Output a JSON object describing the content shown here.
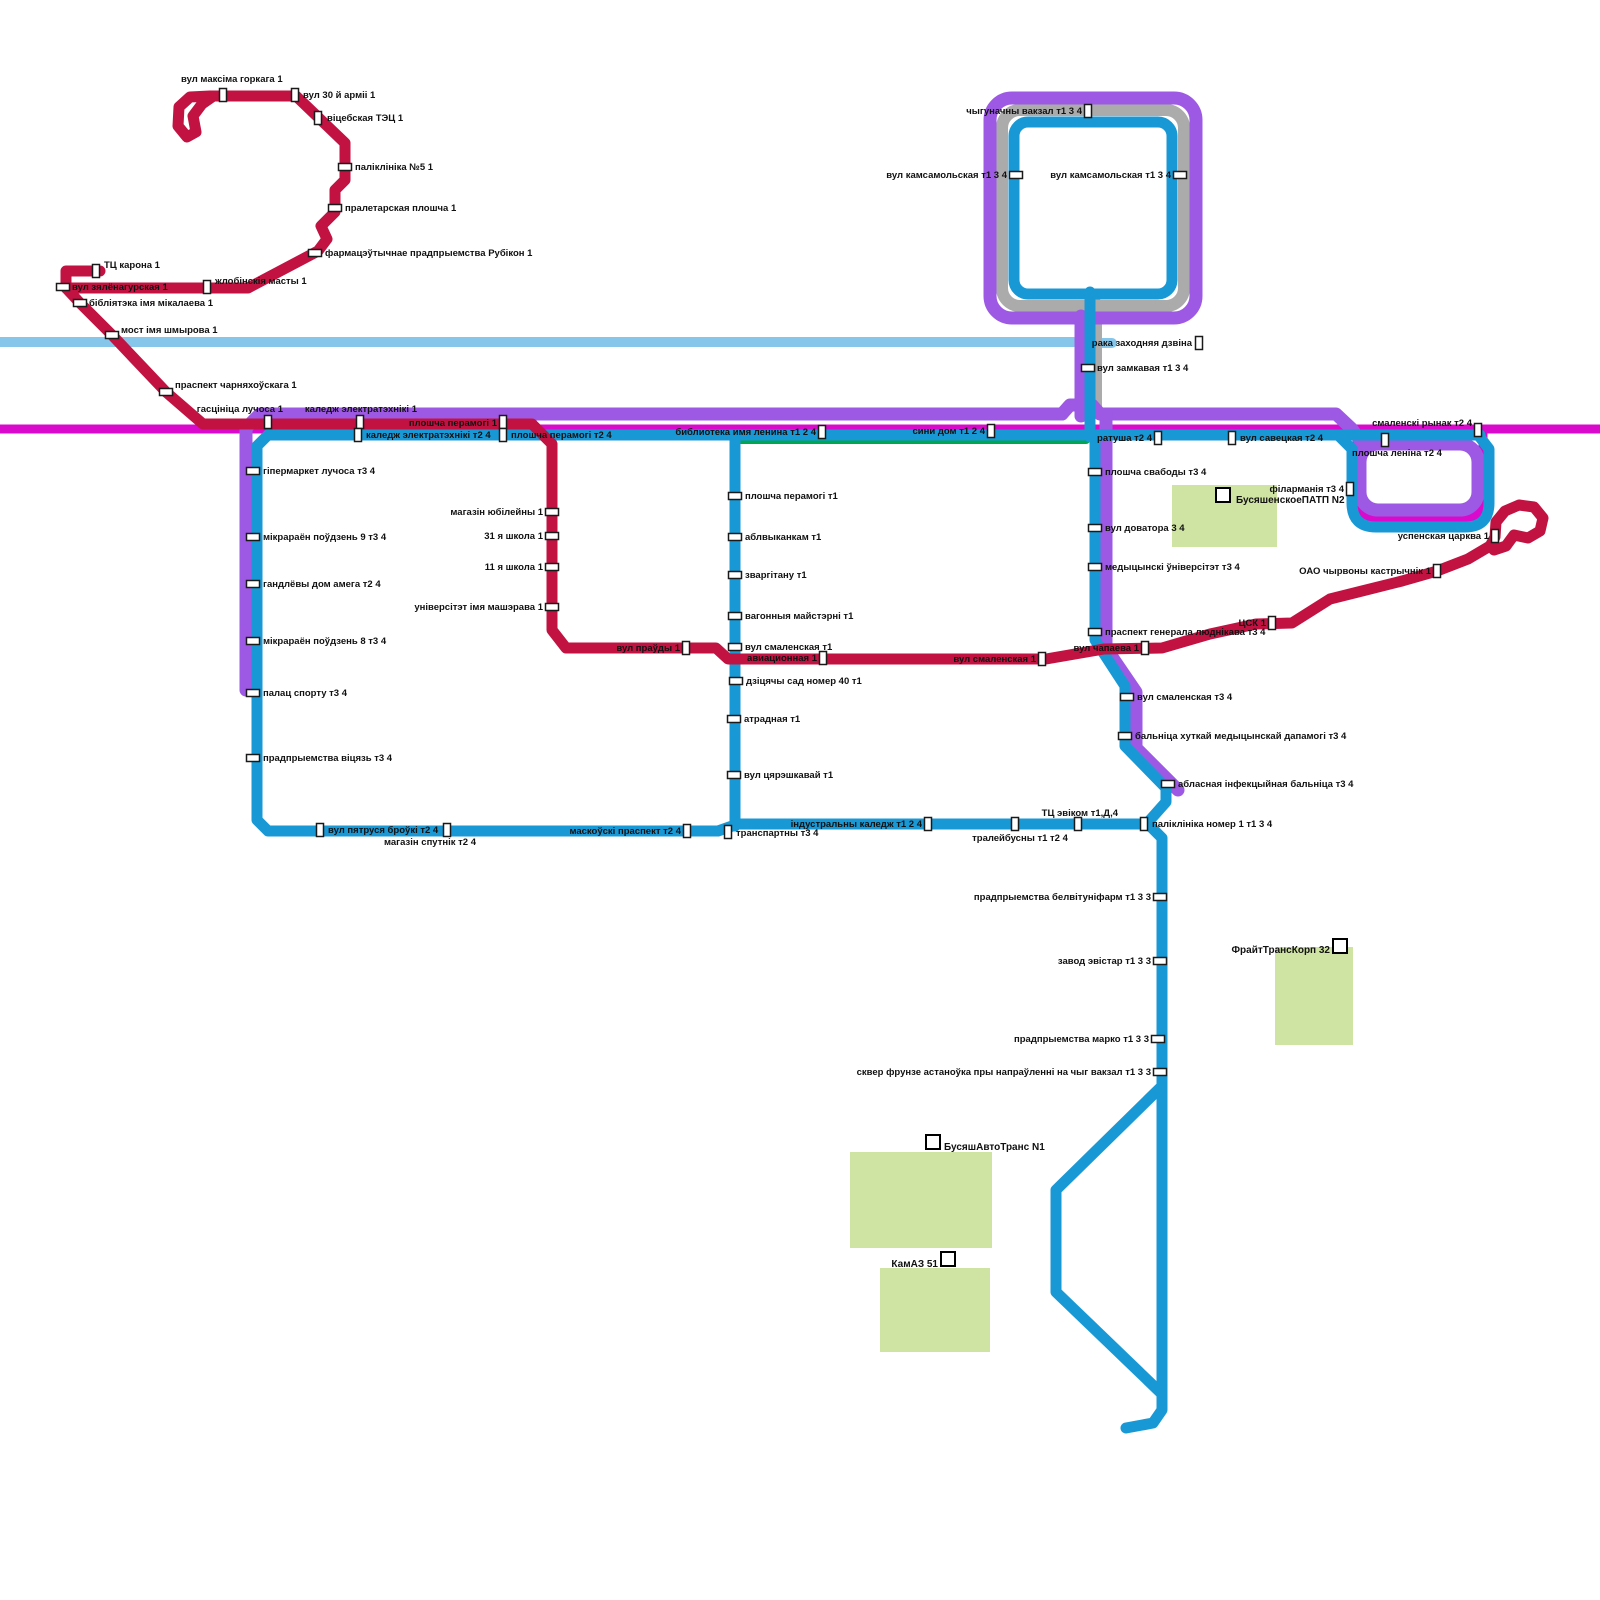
{
  "map": {
    "background": "#ffffff",
    "colors": {
      "crimson_route": "#C11242",
      "blue_route": "#1899D6",
      "purple_route": "#9D59E3",
      "magenta_route": "#D90ACB",
      "green_route": "#00A651",
      "railway": "#ABABAB",
      "river": "#85C6EA",
      "building_fill": "#CFE3A3",
      "marker_fill": "#ffffff",
      "marker_stroke": "#1a1a1a",
      "label_color": "#111111"
    },
    "routes": [
      {
        "name": "river-dzvina",
        "color": "#85C6EA",
        "width": 10,
        "d": [
          "M 0,342 L 1074,342",
          "M 1097,343 L 1112,343"
        ]
      },
      {
        "name": "railway-gray",
        "color": "#ABABAB",
        "width": 12,
        "d": [
          "M 1020,110 L 1166,110 A 18,18 0 0 1 1184,128 L 1184,288 A 18,18 0 0 1 1166,306 L 1020,306 A 18,18 0 0 1 1002,288 L 1002,128 A 18,18 0 0 1 1020,110 Z",
          "M 1096,304 L 1096,406"
        ]
      },
      {
        "name": "magenta-line",
        "color": "#D90ACB",
        "width": 9,
        "d": [
          "M 0,429 L 1600,429",
          "M 1357,429 L 1357,498 Q 1357,519 1378,519 L 1462,519 Q 1483,519 1483,498 L 1483,429"
        ]
      },
      {
        "name": "purple-line",
        "color": "#9D59E3",
        "width": 13,
        "d": [
          "M 246,690 L 246,428 L 260,414 L 1062,414",
          "M 1062,414 L 1070,405 L 1092,405 L 1100,414 L 1336,414 L 1352,429 L 1364,446",
          "M 1378,444 L 1460,444 A 18,18 0 0 1 1478,462 L 1478,492 A 18,18 0 0 1 1460,510 L 1378,510 A 18,18 0 0 1 1360,492 L 1360,462 A 18,18 0 0 1 1378,444 Z",
          "M 1081,416 L 1081,316",
          "M 1012,98 L 1174,98 A 22,22 0 0 1 1196,120 L 1196,296 A 22,22 0 0 1 1174,318 L 1012,318 A 22,22 0 0 1 990,296 L 990,120 A 22,22 0 0 1 1012,98 Z",
          "M 1106,416 L 1106,648 L 1136,692 L 1136,748 L 1178,790"
        ]
      },
      {
        "name": "green-line",
        "color": "#00A651",
        "width": 8,
        "d": [
          "M 740,440 L 1086,440"
        ]
      },
      {
        "name": "blue-line",
        "color": "#1899D6",
        "width": 11,
        "d": [
          "M 268,435 L 1480,435",
          "M 268,435 L 257,446 L 257,820 L 268,831 L 718,831 L 738,824 L 1148,824 L 1162,838 L 1162,1410 L 1153,1423 L 1126,1428",
          "M 1338,435 L 1352,449 L 1352,503 Q 1352,527 1376,527 L 1465,527 Q 1489,527 1489,503 L 1489,449 L 1479,436",
          "M 735,437 L 735,826",
          "M 1095,437 L 1095,640 L 1125,686 L 1125,746 L 1166,788 L 1166,802 L 1150,820",
          "M 1162,1086 L 1056,1190 L 1056,1292 L 1162,1394",
          "M 1028,122 L 1158,122 A 14,14 0 0 1 1172,136 L 1172,280 A 14,14 0 0 1 1158,294 L 1028,294 A 14,14 0 0 1 1014,280 L 1014,136 A 14,14 0 0 1 1028,122 Z",
          "M 1090,292 L 1090,437"
        ]
      },
      {
        "name": "crimson-line",
        "color": "#C11242",
        "width": 11,
        "d": [
          "M 100,271 L 66,271 L 66,288 L 248,288 L 318,251 L 327,239 L 321,226 L 335,212 L 335,190 L 345,180 L 345,143 L 296,96 L 210,96 L 190,97 L 179,107 L 178,126 L 187,137 L 196,132 L 193,116 L 202,104 L 212,97",
          "M 66,288 L 80,303 L 112,335 L 166,392 L 203,424 L 532,424 L 552,444 L 552,630 L 566,648 L 716,648 L 728,659 L 1046,659 L 1104,649 L 1162,648 L 1210,634 L 1256,624 L 1292,623 L 1330,599 L 1362,591 L 1402,581 L 1437,571 L 1468,559 L 1490,546 L 1495,537 L 1496,522 L 1505,511 L 1519,505 L 1534,507 L 1543,518 L 1540,531 L 1528,538 L 1514,535 L 1506,546 L 1494,550"
        ]
      }
    ],
    "stops": [
      [
        223,
        95,
        "v",
        "s",
        181,
        82,
        "вул максіма горкага 1"
      ],
      [
        295,
        95,
        "v",
        "s",
        303,
        98,
        "вул 30 й арміі 1"
      ],
      [
        318,
        118,
        "v",
        "s",
        327,
        121,
        "віцебская ТЭЦ 1"
      ],
      [
        345,
        167,
        "h",
        "s",
        355,
        170,
        "паліклініка №5 1"
      ],
      [
        335,
        208,
        "h",
        "s",
        345,
        211,
        "пралетарская плошча 1"
      ],
      [
        315,
        253,
        "h",
        "s",
        325,
        256,
        "фармацэўтычнае прадпрыемства Рубікон 1"
      ],
      [
        96,
        271,
        "v",
        "s",
        104,
        268,
        "ТЦ карона 1"
      ],
      [
        63,
        287,
        "h",
        "s",
        72,
        290,
        "вул зялёнагурская 1"
      ],
      [
        207,
        287,
        "v",
        "s",
        215,
        284,
        "жлобінскія масты 1"
      ],
      [
        80,
        303,
        "h",
        "s",
        89,
        306,
        "бібліятэка імя мікалаева 1"
      ],
      [
        112,
        335,
        "h",
        "s",
        121,
        333,
        "мост імя шмырова 1"
      ],
      [
        166,
        392,
        "h",
        "s",
        175,
        388,
        "праспект чарняхоўскага 1"
      ],
      [
        268,
        422,
        "v",
        "e",
        283,
        412,
        "гасцініца лучоса 1"
      ],
      [
        360,
        422,
        "v",
        "e",
        417,
        412,
        "каледж электратэхнікі 1"
      ],
      [
        503,
        422,
        "v",
        "e",
        497,
        426,
        "плошча перамогі 1"
      ],
      [
        686,
        648,
        "v",
        "e",
        680,
        651,
        "вул праўды 1"
      ],
      [
        823,
        658,
        "v",
        "e",
        817,
        661,
        "авиационная 1"
      ],
      [
        1042,
        659,
        "v",
        "e",
        1036,
        662,
        "вул смаленская 1"
      ],
      [
        1145,
        648,
        "v",
        "e",
        1139,
        651,
        "вул чапаева 1"
      ],
      [
        1272,
        623,
        "v",
        "e",
        1266,
        626,
        "ЦСК 1"
      ],
      [
        1437,
        571,
        "v",
        "e",
        1431,
        574,
        "ОАО чырвоны кастрычнік 1"
      ],
      [
        1495,
        536,
        "v",
        "e",
        1489,
        539,
        "успенская царква 1"
      ],
      [
        1088,
        111,
        "v",
        "e",
        1082,
        114,
        "чыгуначны вакзал т1 3 4"
      ],
      [
        1016,
        175,
        "h",
        "e",
        1007,
        178,
        "вул камсамольская т1 3 4"
      ],
      [
        1180,
        175,
        "h",
        "e",
        1171,
        178,
        "вул камсамольская т1 3 4"
      ],
      [
        1199,
        343,
        "v",
        "e",
        1192,
        346,
        "рака заходняя дзвіна"
      ],
      [
        1088,
        368,
        "h",
        "s",
        1097,
        371,
        "вул замкавая т1 3 4"
      ],
      [
        822,
        432,
        "v",
        "e",
        816,
        435,
        "библиотека имя ленина т1 2 4"
      ],
      [
        991,
        431,
        "v",
        "e",
        985,
        434,
        "сини дом т1 2 4"
      ],
      [
        1158,
        438,
        "v",
        "e",
        1152,
        441,
        "ратуша т2 4"
      ],
      [
        1232,
        438,
        "v",
        "s",
        1240,
        441,
        "вул савецкая т2 4"
      ],
      [
        1478,
        430,
        "v",
        "e",
        1472,
        426,
        "смаленскі рынак т2 4"
      ],
      [
        1385,
        440,
        "v",
        "s",
        1352,
        456,
        "плошча леніна т2 4"
      ],
      [
        1350,
        489,
        "v",
        "e",
        1344,
        492,
        "філарманія т3 4"
      ],
      [
        358,
        435,
        "v",
        "s",
        366,
        438,
        "каледж электратэхнікі т2 4"
      ],
      [
        503,
        435,
        "v",
        "s",
        511,
        438,
        "плошча перамогі т2 4"
      ],
      [
        253,
        471,
        "h",
        "s",
        263,
        474,
        "гіпермаркет лучоса т3 4"
      ],
      [
        253,
        537,
        "h",
        "s",
        263,
        540,
        "мікрараён поўдзень 9 т3 4"
      ],
      [
        253,
        584,
        "h",
        "s",
        263,
        587,
        "гандлёвы дом амега т2 4"
      ],
      [
        253,
        641,
        "h",
        "s",
        263,
        644,
        "мікрараён поўдзень 8 т3 4"
      ],
      [
        253,
        693,
        "h",
        "s",
        263,
        696,
        "палац спорту т3 4"
      ],
      [
        253,
        758,
        "h",
        "s",
        263,
        761,
        "прадпрыемства віцязь т3 4"
      ],
      [
        320,
        830,
        "v",
        "s",
        328,
        833,
        "вул пятруся броўкі т2 4"
      ],
      [
        447,
        830,
        "v",
        "m",
        430,
        845,
        "магазін спутнік т2 4"
      ],
      [
        687,
        831,
        "v",
        "e",
        681,
        834,
        "маскоўскі праспект т2 4"
      ],
      [
        728,
        832,
        "v",
        "s",
        736,
        836,
        "транспартны т3 4"
      ],
      [
        928,
        824,
        "v",
        "e",
        922,
        827,
        "індустральны каледж т1 2 4"
      ],
      [
        1015,
        824,
        "v",
        "m",
        1020,
        841,
        "тралейбусны т1 т2 4"
      ],
      [
        1078,
        824,
        "v",
        "e",
        1118,
        816,
        "ТЦ эвіком т1,Д,4"
      ],
      [
        1144,
        824,
        "v",
        "s",
        1152,
        827,
        "паліклініка номер 1 т1 3 4"
      ],
      [
        735,
        496,
        "h",
        "s",
        745,
        499,
        "плошча перамогі т1"
      ],
      [
        735,
        537,
        "h",
        "s",
        745,
        540,
        "аблвыканкам т1"
      ],
      [
        735,
        575,
        "h",
        "s",
        745,
        578,
        "зваргітану т1"
      ],
      [
        735,
        616,
        "h",
        "s",
        745,
        619,
        "вагонныя майстэрні т1"
      ],
      [
        735,
        647,
        "h",
        "s",
        745,
        650,
        "вул смаленская т1"
      ],
      [
        736,
        681,
        "h",
        "s",
        746,
        684,
        "дзіцячы сад номер 40 т1"
      ],
      [
        734,
        719,
        "h",
        "s",
        744,
        722,
        "атрадная т1"
      ],
      [
        734,
        775,
        "h",
        "s",
        744,
        778,
        "вул цярэшкавай т1"
      ],
      [
        552,
        512,
        "h",
        "e",
        543,
        515,
        "магазін юбілейны 1"
      ],
      [
        552,
        536,
        "h",
        "e",
        543,
        539,
        "31 я школа 1"
      ],
      [
        552,
        567,
        "h",
        "e",
        543,
        570,
        "11 я школа 1"
      ],
      [
        552,
        607,
        "h",
        "e",
        543,
        610,
        "універсітэт імя машэрава 1"
      ],
      [
        1095,
        472,
        "h",
        "s",
        1105,
        475,
        "плошча свабоды т3 4"
      ],
      [
        1095,
        528,
        "h",
        "s",
        1105,
        531,
        "вул доватора 3 4"
      ],
      [
        1095,
        567,
        "h",
        "s",
        1105,
        570,
        "медыцынскі ўніверсітэт т3 4"
      ],
      [
        1095,
        632,
        "h",
        "s",
        1105,
        635,
        "праспект генерала люднікава т3 4"
      ],
      [
        1127,
        697,
        "h",
        "s",
        1137,
        700,
        "вул смаленская т3 4"
      ],
      [
        1125,
        736,
        "h",
        "s",
        1135,
        739,
        "бальніца хуткай медыцынскай дапамогі т3 4"
      ],
      [
        1168,
        784,
        "h",
        "s",
        1178,
        787,
        "абласная інфекцыйная бальніца т3 4"
      ],
      [
        1160,
        897,
        "h",
        "e",
        1151,
        900,
        "прадпрыемства белвітуніфарм т1 3 3"
      ],
      [
        1160,
        961,
        "h",
        "e",
        1151,
        964,
        "завод эвістар т1 3 3"
      ],
      [
        1158,
        1039,
        "h",
        "e",
        1149,
        1042,
        "прадпрыемства марко т1 3 3"
      ],
      [
        1160,
        1072,
        "h",
        "e",
        1151,
        1075,
        "сквер фрунзе астаноўка пры напраўленні на чыг вакзал т1 3 3"
      ]
    ],
    "buildings": [
      {
        "name": "depot-patp",
        "rect": [
          1172,
          485,
          105,
          62
        ],
        "marker": [
          1223,
          495
        ],
        "ta": "s",
        "lx": 1236,
        "ly": 499,
        "label": "БусяшенскоеПАТП N2"
      },
      {
        "name": "depot-fraight",
        "rect": [
          1275,
          947,
          78,
          98
        ],
        "marker": [
          1340,
          946
        ],
        "ta": "e",
        "lx": 1330,
        "ly": 949,
        "label": "ФрайтТрансКорп 32"
      },
      {
        "name": "depot-avtotrans",
        "rect": [
          850,
          1152,
          142,
          96
        ],
        "marker": [
          933,
          1142
        ],
        "ta": "s",
        "lx": 944,
        "ly": 1146,
        "label": "БусяшАвтоТранс N1"
      },
      {
        "name": "depot-kamaz",
        "rect": [
          880,
          1268,
          110,
          84
        ],
        "marker": [
          948,
          1259
        ],
        "ta": "e",
        "lx": 938,
        "ly": 1263,
        "label": "КамАЗ 51"
      }
    ]
  }
}
